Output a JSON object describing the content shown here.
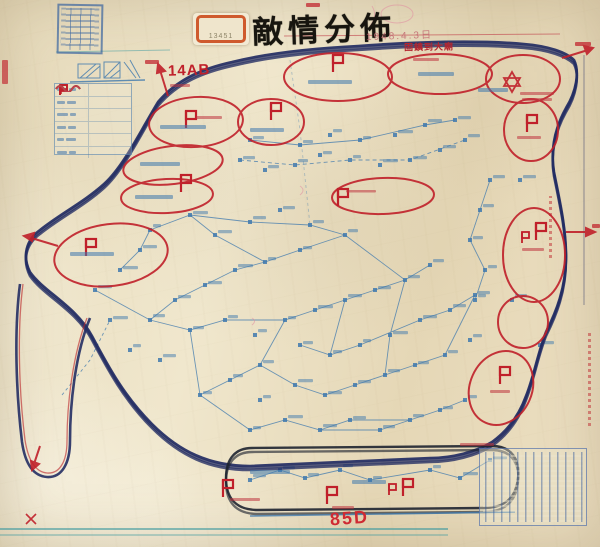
{
  "document": {
    "title": "敵情分佈",
    "date": "1948.4.3日",
    "type_note": "hand-drawn enemy situation map on aged paper"
  },
  "stickers": {
    "archive_number": "13451"
  },
  "annotations": {
    "unit_top": "14AB",
    "route": "固鎮到大廟",
    "unit_bottom": "85D"
  },
  "legend": {
    "rows": [
      {
        "symbol": "red-flag-square"
      },
      {
        "symbol": "red-flag"
      },
      {
        "symbol": "red-flag-small"
      },
      {
        "symbol": "blue-wavy-line"
      },
      {
        "symbol": "green-wavy-line"
      },
      {
        "symbol": "red-wavy-line"
      }
    ]
  },
  "colors": {
    "paper": "#ead fbc",
    "boundary_navy": "#232d63",
    "boundary_green": "#3f6b3a",
    "enemy_red": "#c0202a",
    "village_blue": "#3f79ae",
    "teal_rule": "#3e9aa0",
    "sticker_orange": "#cf5a2d"
  }
}
